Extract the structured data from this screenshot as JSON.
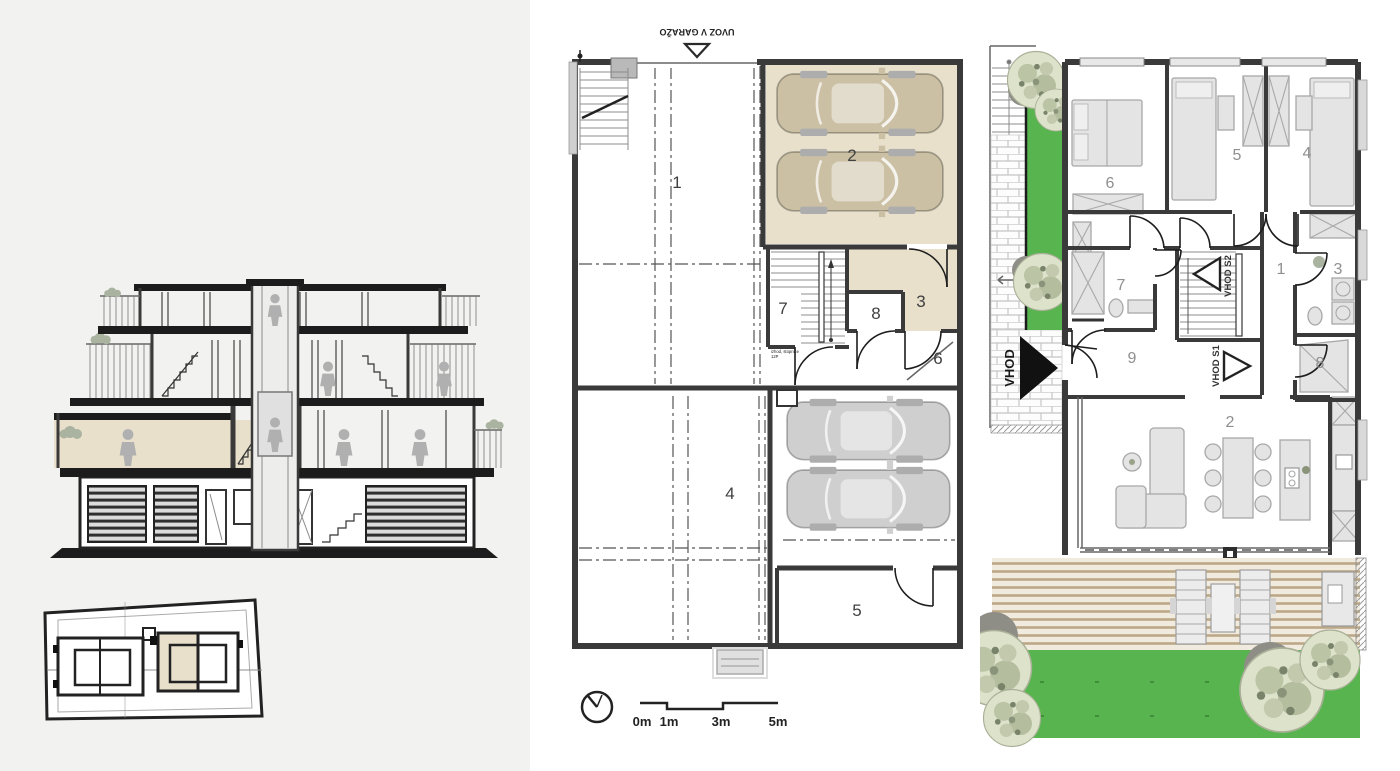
{
  "sheet": {
    "type": "architectural-drawing-sheet",
    "left_panel_background": "#f2f2f0",
    "background": "#ffffff"
  },
  "colors": {
    "beige": "#e8e0cb",
    "grass_green": "#58b44e",
    "wall_dark": "#3a3a3a",
    "car_gray": "#c9c9c9",
    "car_beige": "#cbc0a4",
    "deck_wood": "#bca887",
    "tree_foliage": "#dde2cb",
    "figure_gray": "#b0b0b0"
  },
  "section_view": {
    "name": "building cross-section",
    "site_plan_name": "site plan"
  },
  "basement_plan": {
    "name": "basement / garage floor plan",
    "ramp_label": "UVOZ V GARAŽO",
    "room_labels": {
      "r1": "1",
      "r2": "2",
      "r3": "3",
      "r4": "4",
      "r5": "5",
      "r6": "6",
      "r7": "7",
      "r8": "8"
    },
    "stair_note_line1": "izhod, stopnice",
    "stair_note_line2": "12P",
    "scale_bar": {
      "m0": "0m",
      "m1": "1m",
      "m3": "3m",
      "m5": "5m"
    }
  },
  "ground_plan": {
    "name": "ground floor plan with garden",
    "room_labels": {
      "r1": "1",
      "r2": "2",
      "r3": "3",
      "r4": "4",
      "r5": "5",
      "r6": "6",
      "r7": "7",
      "r8": "8",
      "r9": "9"
    },
    "entrances": {
      "main": "VHOD",
      "s1": "VHOD S1",
      "s2": "VHOD S2"
    }
  }
}
